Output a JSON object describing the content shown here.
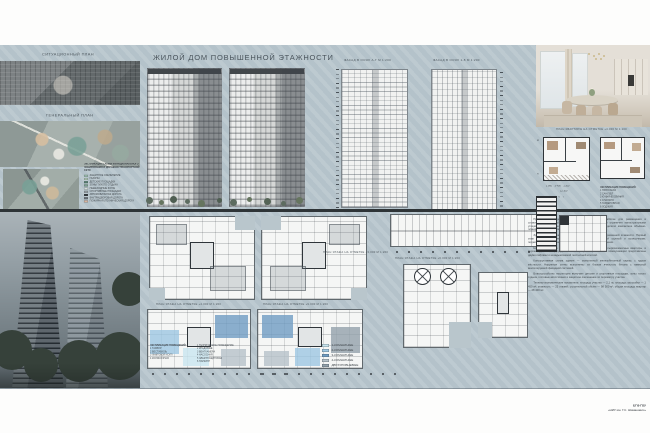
{
  "poster": {
    "title": "ЖИЛОЙ ДОМ ПОВЫШЕННОЙ ЭТАЖНОСТИ",
    "colors": {
      "board": "#b8c6cd",
      "divider": "#2e3437"
    },
    "top_left": {
      "situation_label": "СИТУАЦИОННЫЙ ПЛАН",
      "genplan_label": "ГЕНЕРАЛЬНЫЙ ПЛАН",
      "zoning_legend_title": "ЭКСПЛИКАЦИЯ СХЕМЫ ФУНКЦИОНАЛЬНОГО ЗОНИРОВАНИЯ И ДОРОЖНО-ТРАНСПОРТНОЙ СЕТИ",
      "zoning_legend": [
        {
          "color": "#9dbfae",
          "label": "ЗАЩИТНОЕ ОЗЕЛЕНЕНИЕ"
        },
        {
          "color": "#b9d2bc",
          "label": "ГАЗОНЫ"
        },
        {
          "color": "#55806f",
          "label": "ДЕТСКИЕ ПЛОЩАДКИ"
        },
        {
          "color": "#7ba08e",
          "label": "ЗОНЫ ТИХОГО ОТДЫХА"
        },
        {
          "color": "#d3dcd7",
          "label": "ПЕШЕХОДНЫЕ ЗОНЫ"
        },
        {
          "color": "#98a0a4",
          "label": "СПОРТИВНЫЕ ПЛОЩАДКИ"
        },
        {
          "color": "#2f3438",
          "label": "АВТОМОБИЛЬНАЯ ДОРОГА"
        },
        {
          "color": "#6a7077",
          "label": "ВНУТРИДВОРОВАЯ ДОРОГА"
        },
        {
          "color": "#d9b49e",
          "label": "ПОЖАРНАЯ (ТЕХНИЧЕСКАЯ) ДОРОГА"
        }
      ]
    },
    "facades": {
      "left_label": "ФАСАД В ОСЯХ А-Г М 1:200",
      "right_label": "ФАСАД В ОСЯХ 1-8 М 1:200"
    },
    "apartment": {
      "label": "ПЛАН КВАРТИРЫ НА ОТМЕТКЕ +4.000 М 1:100",
      "axis_letters": [
        "Д",
        "А"
      ],
      "axis_numbers_row": "3     5     6     7",
      "dims_row": "1 900    3 400    1 200",
      "dim_total": "12 100",
      "explication_title": "ЭКСПЛИКАЦИЯ ПОМЕЩЕНИЙ:",
      "explication": [
        "1 ПРИХОЖАЯ",
        "2 САНУЗЕЛ",
        "3 КУХНЯ-ГОСТИНАЯ",
        "4 СПАЛЬНЯ",
        "5 ГАРДЕРОБНАЯ",
        "6 ЛОДЖИЯ"
      ]
    },
    "plan_labels": [
      "ПЛАН ЭТАЖА НА ОТМЕТКЕ +3.000 М 1:200",
      "ПЛАН ЭТАЖА НА ОТМЕТКЕ +6.000 М 1:200",
      "ПЛАН ЭТАЖА НА ОТМЕТКЕ +4.000 М 1:200",
      "ПЛАН ЭТАЖА НА ОТМЕТКЕ +9.000 М 1:200"
    ],
    "apartments_legend": [
      {
        "color": "#c9e6f0",
        "label": "1-КОМНАТНЫЕ"
      },
      {
        "color": "#9ec7e2",
        "label": "2-КОМНАТНЫЕ"
      },
      {
        "color": "#6f9cc3",
        "label": "3-КОМНАТНЫЕ"
      },
      {
        "color": "#b7c2c9",
        "label": "4-КОМНАТНЫЕ"
      },
      {
        "color": "#93a1ab",
        "label": "ДВУХУРОВНЕВЫЕ"
      }
    ],
    "floor_explication_a": {
      "title": "ЭКСПЛИКАЦИЯ ПОМЕЩЕНИЙ:",
      "items": [
        "1 ТАМБУР",
        "2 ВЕСТИБЮЛЬ",
        "3 ЛИФТОВОЙ ХОЛЛ",
        "4 КОЛЯСОЧНАЯ"
      ]
    },
    "floor_explication_b": {
      "items": [
        "1 ТЕХНИЧЕСКОЕ ПОМЕЩЕНИЕ",
        "2 КЛАДОВЫЕ",
        "3 ВЕНТКАМЕРА",
        "4 НАСОСНАЯ",
        "5 ЭЛЕКТРОЩИТОВАЯ",
        "6 ПАРКИНГ"
      ]
    },
    "annotation": [
      "Проект жилого дома повышенной этажности разработан для размещения в сложившейся городской застройке. Участок строительства ограничен магистральными улицами и существующими жилыми кварталами, что определило компактное объёмно-планировочное решение.",
      "Здание представляет собой односекционную башню переменной этажности. Первый этаж занят общественными помещениями, вестибюльной группой и колясочными; подземный уровень отведён под паркинг и технические помещения.",
      "На типовом этаже размещены одно-, двух-, трёх- и четырёхкомнатные квартиры, в верхних уровнях — двухуровневые квартиры. Вертикальные коммуникации представлены двумя лифтами и незадымляемой лестничной клеткой.",
      "Конструктивная схема здания — монолитный железобетонный каркас с ядром жёсткости. Наружные стены выполнены из блоков ячеистого бетона с навесной вентилируемой фасадной системой.",
      "Благоустройство территории включает детские и спортивные площадки, зоны тихого отдыха, гостевые автостоянки и защитное озеленение по периметру участка.",
      "Технико-экономические показатели: площадь участка — 2,1 га; площадь застройки — 1 450 м²; этажность — 25 этажей; строительный объём — 98 500 м³; общая площадь квартир — 28 400 м²."
    ],
    "stamp": {
      "line1": "БГФ ГОУ",
      "line2": "«НИУ им. Г.С. Шиманович»"
    }
  }
}
